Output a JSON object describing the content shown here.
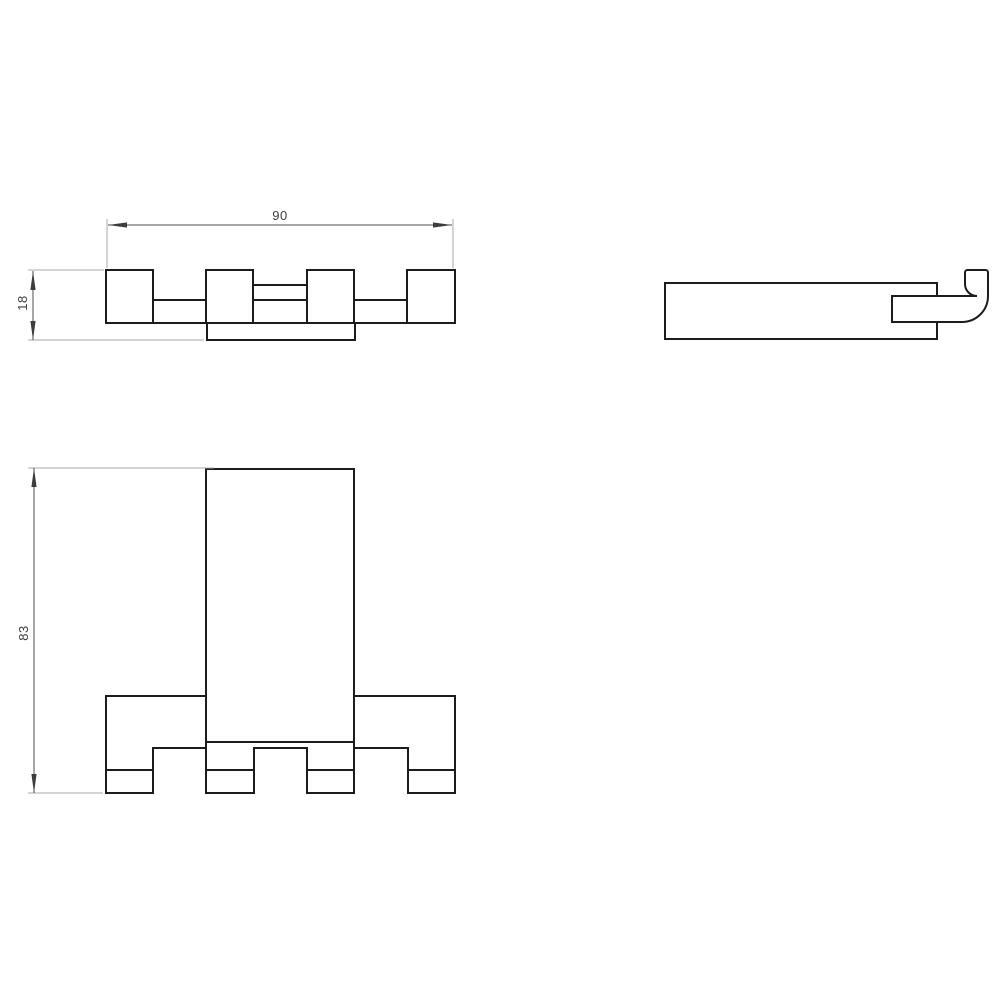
{
  "drawing": {
    "type": "technical-drawing",
    "views": {
      "top": {
        "label": "top-view"
      },
      "side": {
        "label": "side-view"
      },
      "front": {
        "label": "front-view"
      }
    },
    "dimensions": {
      "width": {
        "value": "90"
      },
      "depth": {
        "value": "18"
      },
      "height": {
        "value": "83"
      }
    },
    "colors": {
      "outline": "#1c1c1c",
      "dimension_line": "#4d4d4d",
      "extension_line": "#a8a8a8",
      "text": "#3d3d3d",
      "background": "#ffffff"
    }
  }
}
